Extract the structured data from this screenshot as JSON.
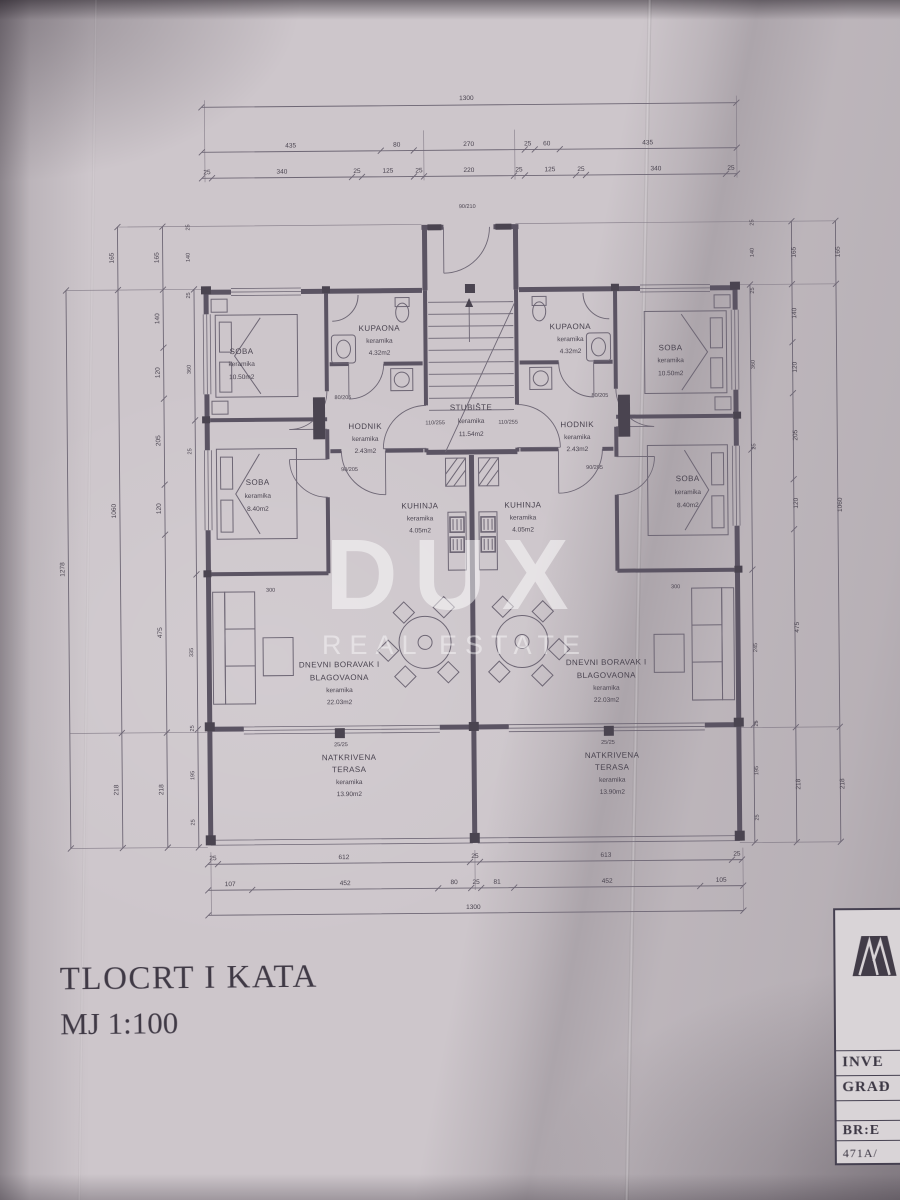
{
  "colors": {
    "paper": "#cdc6cb",
    "ink": "#4d4754",
    "watermark": "#ffffff",
    "titleblock_bg": "#d9d4d7"
  },
  "watermark": {
    "line1": "DUX",
    "line2": "REAL ESTATE"
  },
  "caption": {
    "line1": "TLOCRT I KATA",
    "line2": "MJ 1:100"
  },
  "titleblock": {
    "rows": [
      "INVE",
      "GRAĐ",
      "BR:E",
      "471A/"
    ]
  },
  "plan": {
    "stairs": {
      "name": "STUBIŠTE",
      "material": "keramika",
      "area": "11.54m2"
    },
    "unit_left": {
      "soba1": {
        "name": "SOBA",
        "material": "keramika",
        "area": "10.50m2"
      },
      "kupaona": {
        "name": "KUPAONA",
        "material": "keramika",
        "area": "4.32m2"
      },
      "hodnik": {
        "name": "HODNIK",
        "material": "keramika",
        "area": "2.43m2"
      },
      "soba2": {
        "name": "SOBA",
        "material": "keramika",
        "area": "8.40m2"
      },
      "kuhinja": {
        "name": "KUHINJA",
        "material": "keramika",
        "area": "4.05m2"
      },
      "dnevni": {
        "line1": "DNEVNI BORAVAK I",
        "line2": "BLAGOVAONA",
        "material": "keramika",
        "area": "22.03m2"
      },
      "terasa": {
        "line1": "NATKRIVENA",
        "line2": "TERASA",
        "material": "keramika",
        "area": "13.90m2"
      }
    },
    "unit_right": {
      "soba1": {
        "name": "SOBA",
        "material": "keramika",
        "area": "10.50m2"
      },
      "kupaona": {
        "name": "KUPAONA",
        "material": "keramika",
        "area": "4.32m2"
      },
      "hodnik": {
        "name": "HODNIK",
        "material": "keramika",
        "area": "2.43m2"
      },
      "soba2": {
        "name": "SOBA",
        "material": "keramika",
        "area": "8.40m2"
      },
      "kuhinja": {
        "name": "KUHINJA",
        "material": "keramika",
        "area": "4.05m2"
      },
      "dnevni": {
        "line1": "DNEVNI BORAVAK I",
        "line2": "BLAGOVAONA",
        "material": "keramika",
        "area": "22.03m2"
      },
      "terasa": {
        "line1": "NATKRIVENA",
        "line2": "TERASA",
        "material": "keramika",
        "area": "13.90m2"
      }
    },
    "dims": {
      "top_total": "1300",
      "top_row2": [
        "435",
        "80",
        "270",
        "25",
        "60",
        "435"
      ],
      "top_row3": [
        "25",
        "340",
        "25",
        "125",
        "25",
        "220",
        "25",
        "125",
        "25",
        "340",
        "25"
      ],
      "bottom_row1": [
        "25",
        "612",
        "25",
        "613",
        "25"
      ],
      "bottom_row2": [
        "107",
        "452",
        "80",
        "25",
        "81",
        "452",
        "105"
      ],
      "bottom_total": "1300",
      "left_total": "1278",
      "left_col2": [
        "165",
        "1060",
        "218"
      ],
      "left_col3": [
        "165",
        "140",
        "120",
        "205",
        "120",
        "475",
        "218"
      ],
      "left_col4": [
        "25",
        "140",
        "25",
        "360",
        "25",
        "335",
        "25",
        "195",
        "25"
      ],
      "right_col2": [
        "165",
        "1060",
        "218"
      ],
      "right_col3": [
        "165",
        "140",
        "120",
        "205",
        "120",
        "475",
        "218"
      ],
      "right_col4": [
        "25",
        "140",
        "25",
        "360",
        "25",
        "245",
        "25",
        "195",
        "25"
      ],
      "door_labels": [
        "90/210",
        "110/255",
        "110/255",
        "90/205",
        "90/205",
        "80/205",
        "80/205",
        "25/25",
        "25/25",
        "300",
        "300"
      ]
    }
  }
}
